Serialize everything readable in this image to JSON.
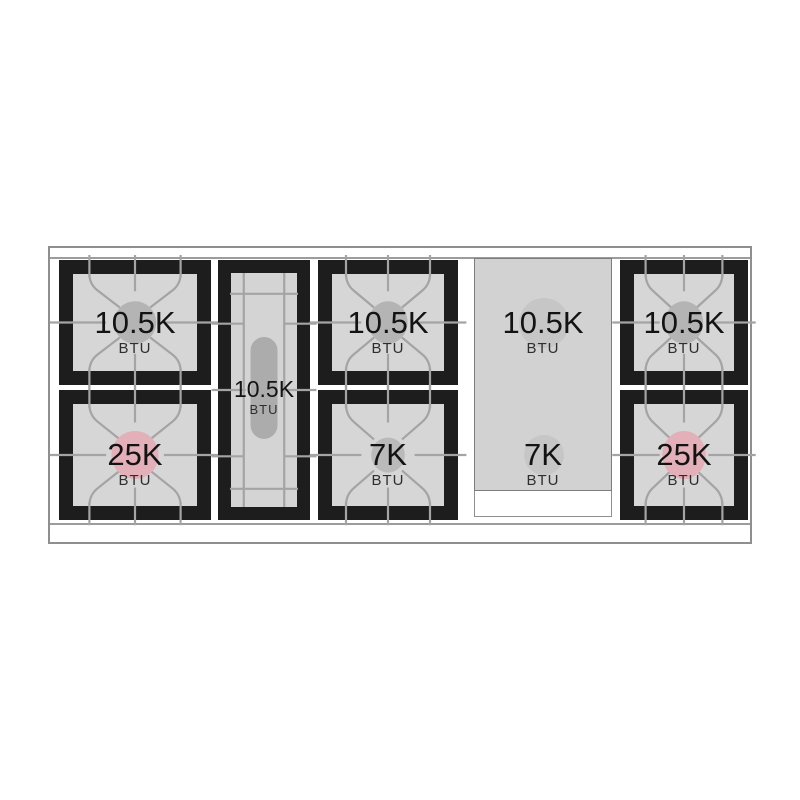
{
  "figure": {
    "kind": "range-cooktop-burner-layout-diagram",
    "unit": "BTU"
  },
  "sections": [
    {
      "name": "left-burner-pair",
      "burners": [
        {
          "value": "10.5K",
          "unit": "BTU",
          "style": "standard"
        },
        {
          "value": "25K",
          "unit": "BTU",
          "style": "power"
        }
      ]
    },
    {
      "name": "oval-burner",
      "burners": [
        {
          "value": "10.5K",
          "unit": "BTU",
          "style": "oval"
        }
      ]
    },
    {
      "name": "center-burner-pair",
      "burners": [
        {
          "value": "10.5K",
          "unit": "BTU",
          "style": "standard"
        },
        {
          "value": "7K",
          "unit": "BTU",
          "style": "simmer"
        }
      ]
    },
    {
      "name": "griddle-burner-pair",
      "burners": [
        {
          "value": "10.5K",
          "unit": "BTU",
          "style": "standard"
        },
        {
          "value": "7K",
          "unit": "BTU",
          "style": "simmer"
        }
      ]
    },
    {
      "name": "right-burner-pair",
      "burners": [
        {
          "value": "10.5K",
          "unit": "BTU",
          "style": "standard"
        },
        {
          "value": "25K",
          "unit": "BTU",
          "style": "power"
        }
      ]
    }
  ],
  "colors": {
    "grate_frame": "#1d1d1d",
    "burner_bed": "#d6d6d6",
    "grate_line": "#a4a4a4",
    "standard_burner_ring": "#b4b4b4",
    "power_burner_ring": "#e3afb8",
    "oval_burner_bar": "#acacac",
    "griddle_panel": "#d2d2d2",
    "outline": "#8f8f8f"
  }
}
